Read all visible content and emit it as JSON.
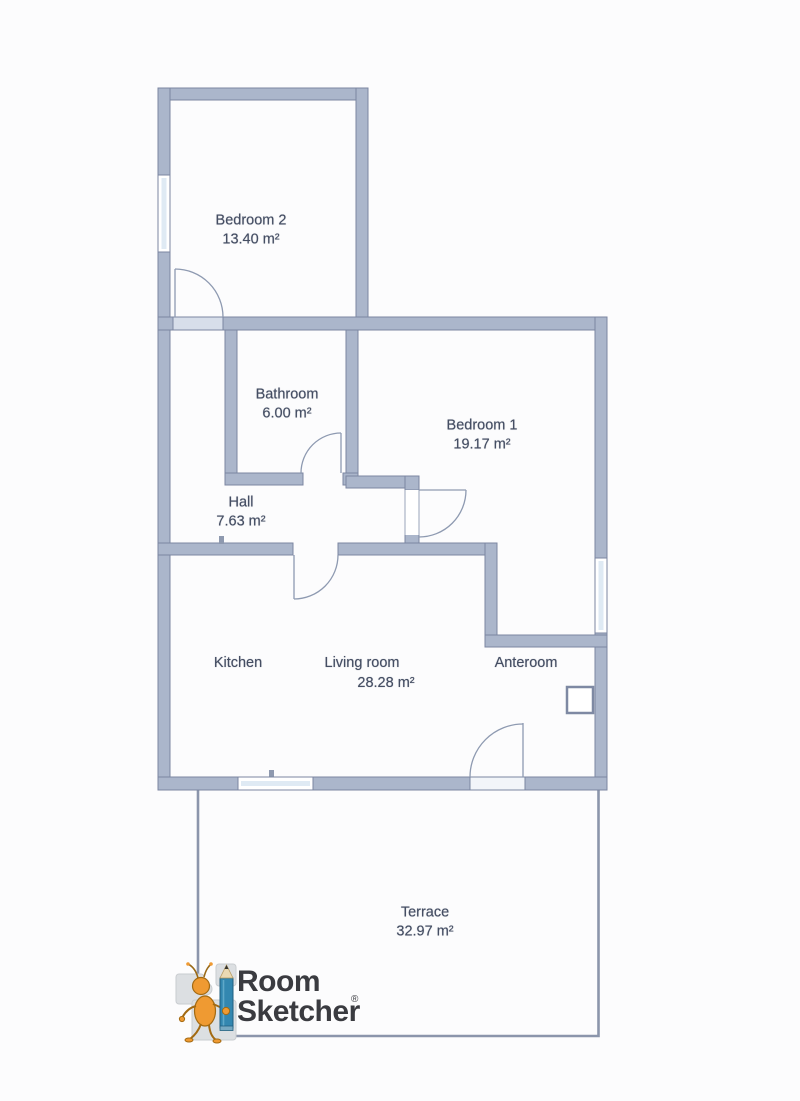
{
  "page": {
    "type": "floor-plan"
  },
  "rooms": {
    "bedroom2": {
      "name": "Bedroom 2",
      "area": "13.40 m²"
    },
    "bathroom": {
      "name": "Bathroom",
      "area": "6.00 m²"
    },
    "bedroom1": {
      "name": "Bedroom 1",
      "area": "19.17 m²"
    },
    "hall": {
      "name": "Hall",
      "area": "7.63 m²"
    },
    "kitchen": {
      "name": "Kitchen"
    },
    "living_room": {
      "name": "Living room",
      "area": "28.28 m²"
    },
    "anteroom": {
      "name": "Anteroom"
    },
    "terrace": {
      "name": "Terrace",
      "area": "32.97 m²"
    }
  },
  "branding": {
    "name_line1": "Room",
    "name_line2": "Sketcher",
    "registered_mark": "®"
  },
  "colors": {
    "wall_fill": "#abb6cb",
    "wall_edge": "#7b86a1",
    "window_glass": "#dfeaf4",
    "door_swing": "#8e9ab1",
    "terrace_outline": "#8b95ab",
    "label_text": "#454e63",
    "logo_text": "#3a3b40",
    "logo_character_orange": "#ef9a32",
    "logo_pencil_blue": "#3387b0"
  }
}
